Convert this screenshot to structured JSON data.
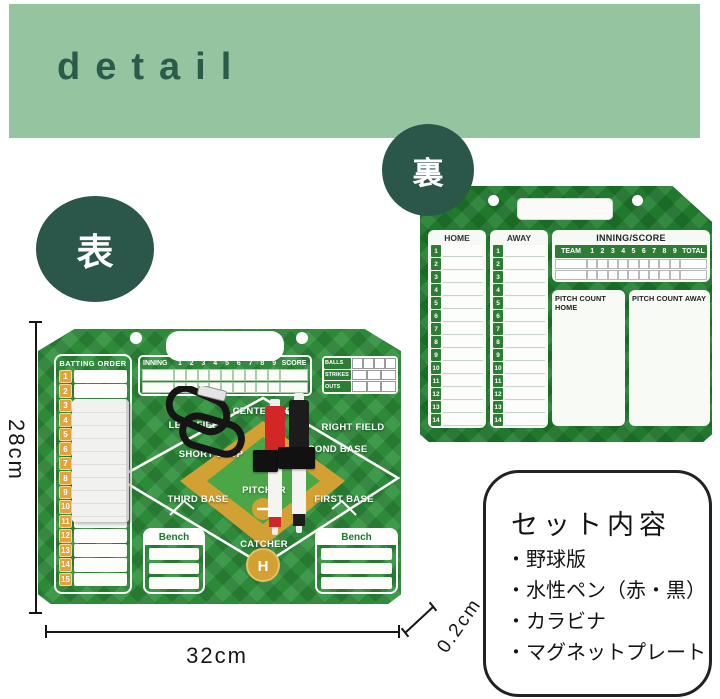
{
  "header": {
    "title": "detail"
  },
  "badges": {
    "front": "表",
    "back": "裏"
  },
  "front_board": {
    "batting_order": {
      "title": "BATTING ORDER",
      "rows": [
        "1",
        "2",
        "3",
        "4",
        "5",
        "6",
        "7",
        "8",
        "9",
        "10",
        "11",
        "12",
        "13",
        "14",
        "15"
      ]
    },
    "inning_table": {
      "label": "INNING",
      "innings": [
        "1",
        "2",
        "3",
        "4",
        "5",
        "6",
        "7",
        "8",
        "9"
      ],
      "score_label": "SCORE",
      "body_rows": 2
    },
    "count_panel": {
      "rows": [
        {
          "label": "BALLS",
          "cells": 4
        },
        {
          "label": "STRIKES",
          "cells": 3
        },
        {
          "label": "OUTS",
          "cells": 3
        }
      ]
    },
    "field": {
      "center": "CENTER FIELD",
      "left": "LEFT FIELD",
      "right": "RIGHT FIELD",
      "short_stop": "SHORT STOP",
      "second_base": "SECOND BASE",
      "third_base": "THIRD BASE",
      "pitcher": "PITCHER",
      "first_base": "FIRST BASE",
      "catcher": "CATCHER",
      "home_plate": "H"
    },
    "bench": {
      "label": "Bench",
      "slots": 3
    }
  },
  "back_board": {
    "home": {
      "title": "HOME",
      "rows": [
        "1",
        "2",
        "3",
        "4",
        "5",
        "6",
        "7",
        "8",
        "9",
        "10",
        "11",
        "12",
        "13",
        "14"
      ]
    },
    "away": {
      "title": "AWAY",
      "rows": [
        "1",
        "2",
        "3",
        "4",
        "5",
        "6",
        "7",
        "8",
        "9",
        "10",
        "11",
        "12",
        "13",
        "14"
      ]
    },
    "inning_score": {
      "title": "INNING/SCORE",
      "team_label": "TEAM",
      "innings": [
        "1",
        "2",
        "3",
        "4",
        "5",
        "6",
        "7",
        "8",
        "9"
      ],
      "total_label": "TOTAL",
      "body_rows": 2
    },
    "pitch_count_home": "PITCH COUNT HOME",
    "pitch_count_away": "PITCH COUNT AWAY"
  },
  "dimensions": {
    "height": "28cm",
    "width": "32cm",
    "thickness": "0.2cm"
  },
  "set_contents": {
    "title": "セット内容",
    "items": [
      "・野球版",
      "・水性ペン（赤・黒）",
      "・カラビナ",
      "・マグネットプレート"
    ]
  },
  "colors": {
    "banner": "#95c4a1",
    "banner_text": "#2a5c49",
    "badge": "#2b574a",
    "front_green": "#2f923c",
    "back_green": "#217f2f",
    "gold": "#d3a133",
    "infield_inner_green": "#4aa647",
    "pen_red": "#d32727",
    "pen_black": "#1c1c1c",
    "tile_orange": "#e2a23c",
    "tile_green": "#2e7d36"
  }
}
